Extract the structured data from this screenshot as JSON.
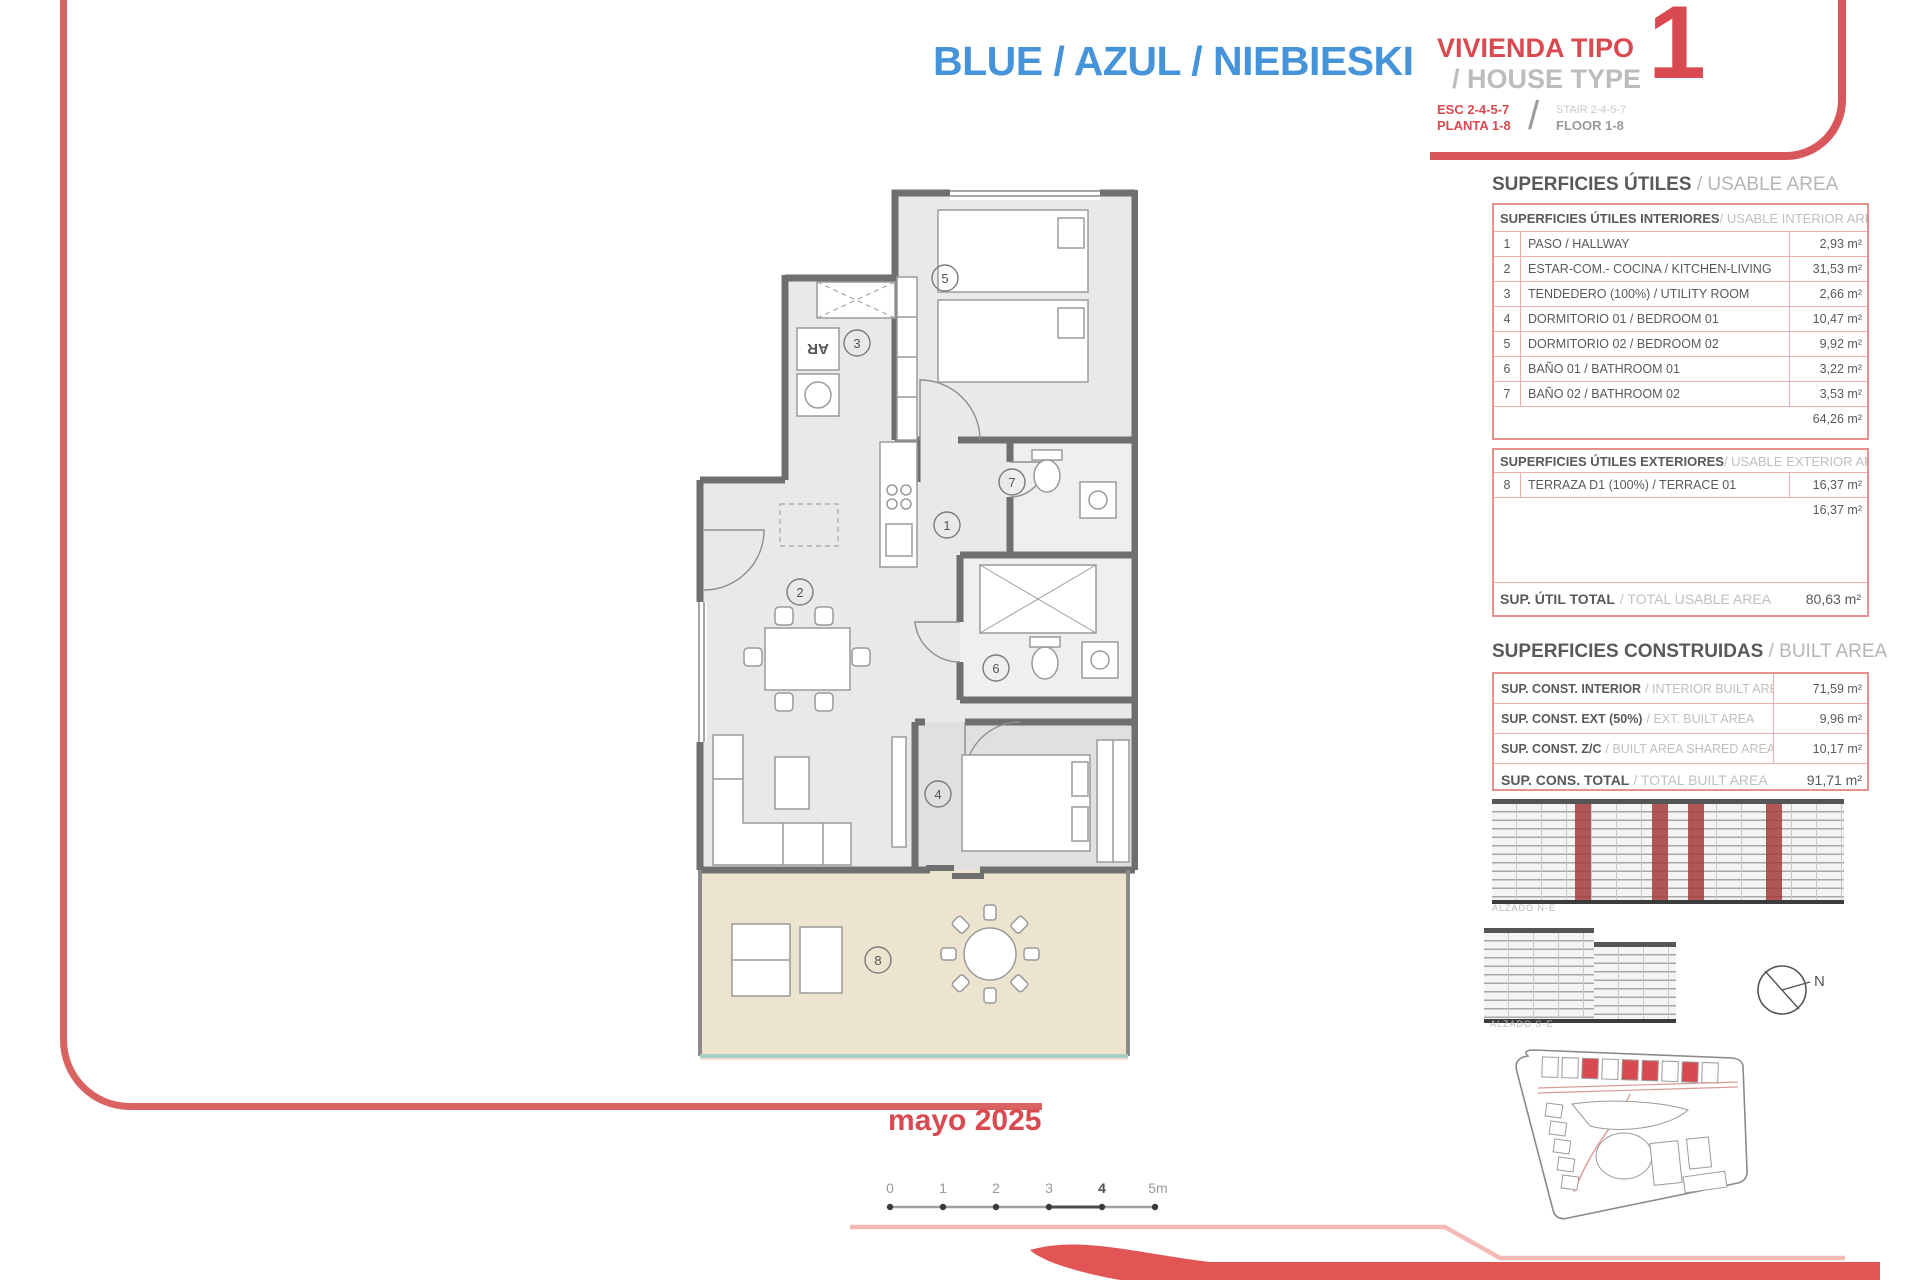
{
  "header": {
    "title_blue": "BLUE / AZUL / NIEBIESKI",
    "house_type_es": "VIVIENDA TIPO",
    "house_type_en": "/ HOUSE TYPE",
    "house_type_number": "1",
    "stair_es": "ESC 2-4-5-7",
    "floor_es": "PLANTA 1-8",
    "stair_en": "STAIR 2-4-5-7",
    "floor_en": "FLOOR 1-8",
    "divider": "/"
  },
  "usable_area": {
    "title_es": "SUPERFICIES ÚTILES",
    "title_en": "/ USABLE AREA",
    "interior": {
      "header_es": "SUPERFICIES ÚTILES INTERIORES ",
      "header_en": "/ USABLE INTERIOR AREA",
      "rows": [
        {
          "num": "1",
          "label": "PASO / HALLWAY",
          "value": "2,93 m²"
        },
        {
          "num": "2",
          "label": "ESTAR-COM.- COCINA / KITCHEN-LIVING",
          "value": "31,53 m²"
        },
        {
          "num": "3",
          "label": "TENDEDERO (100%) / UTILITY ROOM",
          "value": "2,66 m²"
        },
        {
          "num": "4",
          "label": "DORMITORIO 01 / BEDROOM 01",
          "value": "10,47 m²"
        },
        {
          "num": "5",
          "label": "DORMITORIO 02 / BEDROOM 02",
          "value": "9,92 m²"
        },
        {
          "num": "6",
          "label": "BAÑO 01 / BATHROOM 01",
          "value": "3,22 m²"
        },
        {
          "num": "7",
          "label": "BAÑO 02 / BATHROOM 02",
          "value": "3,53 m²"
        }
      ],
      "subtotal": "64,26 m²"
    },
    "exterior": {
      "header_es": "SUPERFICIES ÚTILES EXTERIORES ",
      "header_en": "/ USABLE EXTERIOR AREA",
      "rows": [
        {
          "num": "8",
          "label": "TERRAZA D1 (100%) / TERRACE 01",
          "value": "16,37 m²"
        }
      ],
      "subtotal": "16,37 m²"
    },
    "total_label_es": "SUP. ÚTIL TOTAL",
    "total_label_en": "/ TOTAL USABLE AREA",
    "total_value": "80,63 m²"
  },
  "built_area": {
    "title_es": "SUPERFICIES CONSTRUIDAS",
    "title_en": "/ BUILT AREA",
    "rows": [
      {
        "label_es": "SUP. CONST. INTERIOR",
        "label_en": "/ INTERIOR BUILT AREA",
        "value": "71,59 m²"
      },
      {
        "label_es": "SUP. CONST. EXT (50%)",
        "label_en": "/ EXT. BUILT AREA",
        "value": "9,96 m²"
      },
      {
        "label_es": "SUP. CONST. Z/C",
        "label_en": "/ BUILT AREA SHARED AREAS",
        "value": "10,17 m²"
      }
    ],
    "total_label_es": "SUP. CONS. TOTAL",
    "total_label_en": "/ TOTAL BUILT AREA",
    "total_value": "91,71 m²"
  },
  "elevations": {
    "label_1": "ALZADO N-E",
    "label_2": "ALZADO S-E"
  },
  "compass": {
    "label": "N"
  },
  "footer": {
    "date": "mayo 2025",
    "scale_ticks": [
      "0",
      "1",
      "2",
      "3",
      "4",
      "5m"
    ]
  },
  "floor_plan": {
    "room_numbers": [
      "1",
      "2",
      "3",
      "4",
      "5",
      "6",
      "7",
      "8"
    ],
    "washer_label": "AR"
  },
  "colors": {
    "accent_red": "#d84a50",
    "frame_red": "#d96361",
    "title_blue": "#4593d9",
    "table_border": "#e5928e",
    "text_dark": "#58595b",
    "text_light": "#b5b5b5",
    "terrace_floor": "#ece4cf"
  }
}
